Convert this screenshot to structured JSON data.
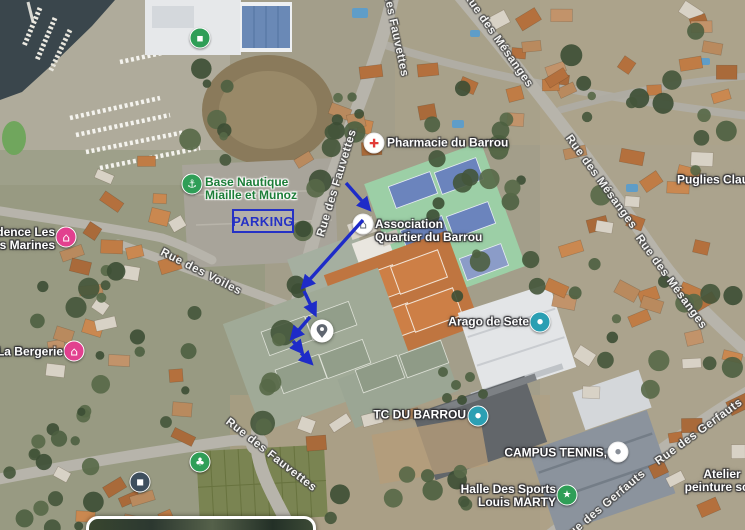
{
  "map": {
    "parking": {
      "label": "PARKING",
      "color": "#2531c5"
    },
    "pois": [
      {
        "name": "pharmacie-du-barrou",
        "icon": {
          "x": 374,
          "y": 143,
          "bg": "#ffffff",
          "fg": "#e23c39",
          "glyph": "cross-icon"
        },
        "label": {
          "x": 387,
          "y": 143,
          "align": "left",
          "lines": [
            "Pharmacie du Barrou"
          ],
          "color": "#ffffff"
        }
      },
      {
        "name": "base-nautique",
        "icon": {
          "x": 192,
          "y": 184,
          "bg": "#2f9e57",
          "fg": "#ffffff",
          "glyph": "anchor-icon"
        },
        "label": {
          "x": 205,
          "y": 189,
          "align": "left",
          "lines": [
            "Base Nautique",
            "Miaille et Munoz"
          ],
          "color": "#1c7d38",
          "halo": "light"
        }
      },
      {
        "name": "association-quartier-du-barrou",
        "icon": {
          "x": 363,
          "y": 224,
          "bg": "#ffffff",
          "fg": "#5f6a75",
          "glyph": "home-icon"
        },
        "label": {
          "x": 375,
          "y": 231,
          "align": "left",
          "lines": [
            "Association",
            "Quartier du Barrou"
          ],
          "color": "#ffffff"
        }
      },
      {
        "name": "residence-les-terres-marines",
        "icon": {
          "x": 66,
          "y": 237,
          "bg": "#e2408f",
          "fg": "#ffffff",
          "glyph": "home-icon"
        },
        "label": {
          "x": 55,
          "y": 239,
          "align": "right",
          "lines": [
            "Résidence Les",
            "Terres Marines"
          ],
          "color": "#ffffff"
        }
      },
      {
        "name": "la-bergerie",
        "icon": {
          "x": 74,
          "y": 351,
          "bg": "#e2408f",
          "fg": "#ffffff",
          "glyph": "home-icon"
        },
        "label": {
          "x": 63,
          "y": 352,
          "align": "right",
          "lines": [
            "La Bergerie"
          ],
          "color": "#ffffff"
        }
      },
      {
        "name": "arago-de-sete",
        "icon": {
          "x": 540,
          "y": 322,
          "bg": "#2b9fb3",
          "fg": "#ffffff",
          "glyph": "dot-icon"
        },
        "label": {
          "x": 529,
          "y": 322,
          "align": "right",
          "lines": [
            "Arago de Sete"
          ],
          "color": "#ffffff"
        }
      },
      {
        "name": "tc-du-barrou",
        "icon": {
          "x": 478,
          "y": 416,
          "bg": "#2b9fb3",
          "fg": "#ffffff",
          "glyph": "dot-icon"
        },
        "label": {
          "x": 466,
          "y": 415,
          "align": "right",
          "lines": [
            "TC DU BARROU"
          ],
          "color": "#ffffff"
        }
      },
      {
        "name": "campus-tennis",
        "icon": {
          "x": 618,
          "y": 452,
          "bg": "#ffffff",
          "fg": "#8a9099",
          "glyph": "dot-icon"
        },
        "label": {
          "x": 607,
          "y": 453,
          "align": "right",
          "lines": [
            "CAMPUS TENNIS,"
          ],
          "color": "#ffffff"
        }
      },
      {
        "name": "halle-des-sports-louis-marty",
        "icon": {
          "x": 567,
          "y": 495,
          "bg": "#2f9e57",
          "fg": "#ffffff",
          "glyph": "star-icon"
        },
        "label": {
          "x": 556,
          "y": 496,
          "align": "right",
          "lines": [
            "Halle Des Sports",
            "Louis MARTY"
          ],
          "color": "#ffffff"
        }
      },
      {
        "name": "puglies-claudi",
        "label": {
          "x": 677,
          "y": 180,
          "align": "left",
          "lines": [
            "Puglies Claudi"
          ],
          "color": "#ffffff"
        }
      },
      {
        "name": "atelier-peinture",
        "label": {
          "x": 722,
          "y": 481,
          "align": "center",
          "lines": [
            "Atelier",
            "peinture scul"
          ],
          "color": "#ffffff"
        }
      },
      {
        "name": "boatyard-store",
        "icon": {
          "x": 200,
          "y": 38,
          "bg": "#2f9e57",
          "fg": "#ffffff",
          "glyph": "bag-icon"
        }
      },
      {
        "name": "community-garden",
        "icon": {
          "x": 200,
          "y": 462,
          "bg": "#2f9e57",
          "fg": "#ffffff",
          "glyph": "clover-icon"
        }
      },
      {
        "name": "bus-stop",
        "icon": {
          "x": 140,
          "y": 482,
          "bg": "#3e4f5e",
          "fg": "#ffffff",
          "glyph": "bus-icon"
        }
      }
    ],
    "streets": [
      {
        "name": "rue-des-fauvettes-top",
        "text": "Rue des Fauvettes",
        "x": 393,
        "y": 22,
        "rot": 78
      },
      {
        "name": "rue-des-fauvettes-mid",
        "text": "Rue des Fauvettes",
        "x": 337,
        "y": 183,
        "rot": -73
      },
      {
        "name": "rue-des-fauvettes-bottom",
        "text": "Rue des Fauvettes",
        "x": 271,
        "y": 455,
        "rot": 38
      },
      {
        "name": "rue-des-mesanges-top",
        "text": "Rue des Mésanges",
        "x": 498,
        "y": 40,
        "rot": 55
      },
      {
        "name": "rue-des-mesanges-mid",
        "text": "Rue des Mésanges",
        "x": 601,
        "y": 182,
        "rot": 54
      },
      {
        "name": "rue-des-mesanges-low",
        "text": "Rue des Mésanges",
        "x": 671,
        "y": 282,
        "rot": 54
      },
      {
        "name": "rue-des-voiles",
        "text": "Rue des Voiles",
        "x": 201,
        "y": 272,
        "rot": 27
      },
      {
        "name": "rue-des-gerfauts-right",
        "text": "Rue des Gerfauts",
        "x": 699,
        "y": 432,
        "rot": -36
      },
      {
        "name": "rue-des-gerfauts-bottom",
        "text": "Rue des Gerfauts",
        "x": 604,
        "y": 506,
        "rot": -40
      }
    ]
  },
  "annotations": {
    "arrow_color": "#1e2bc8",
    "arrows": [
      {
        "x1": 346,
        "y1": 183,
        "x2": 369,
        "y2": 209
      },
      {
        "x1": 363,
        "y1": 220,
        "x2": 303,
        "y2": 287
      },
      {
        "x1": 304,
        "y1": 291,
        "x2": 315,
        "y2": 314
      },
      {
        "x1": 310,
        "y1": 317,
        "x2": 292,
        "y2": 338
      },
      {
        "x1": 293,
        "y1": 341,
        "x2": 302,
        "y2": 352
      },
      {
        "x1": 301,
        "y1": 353,
        "x2": 311,
        "y2": 363
      }
    ],
    "pin": {
      "x": 322,
      "y": 331
    }
  }
}
